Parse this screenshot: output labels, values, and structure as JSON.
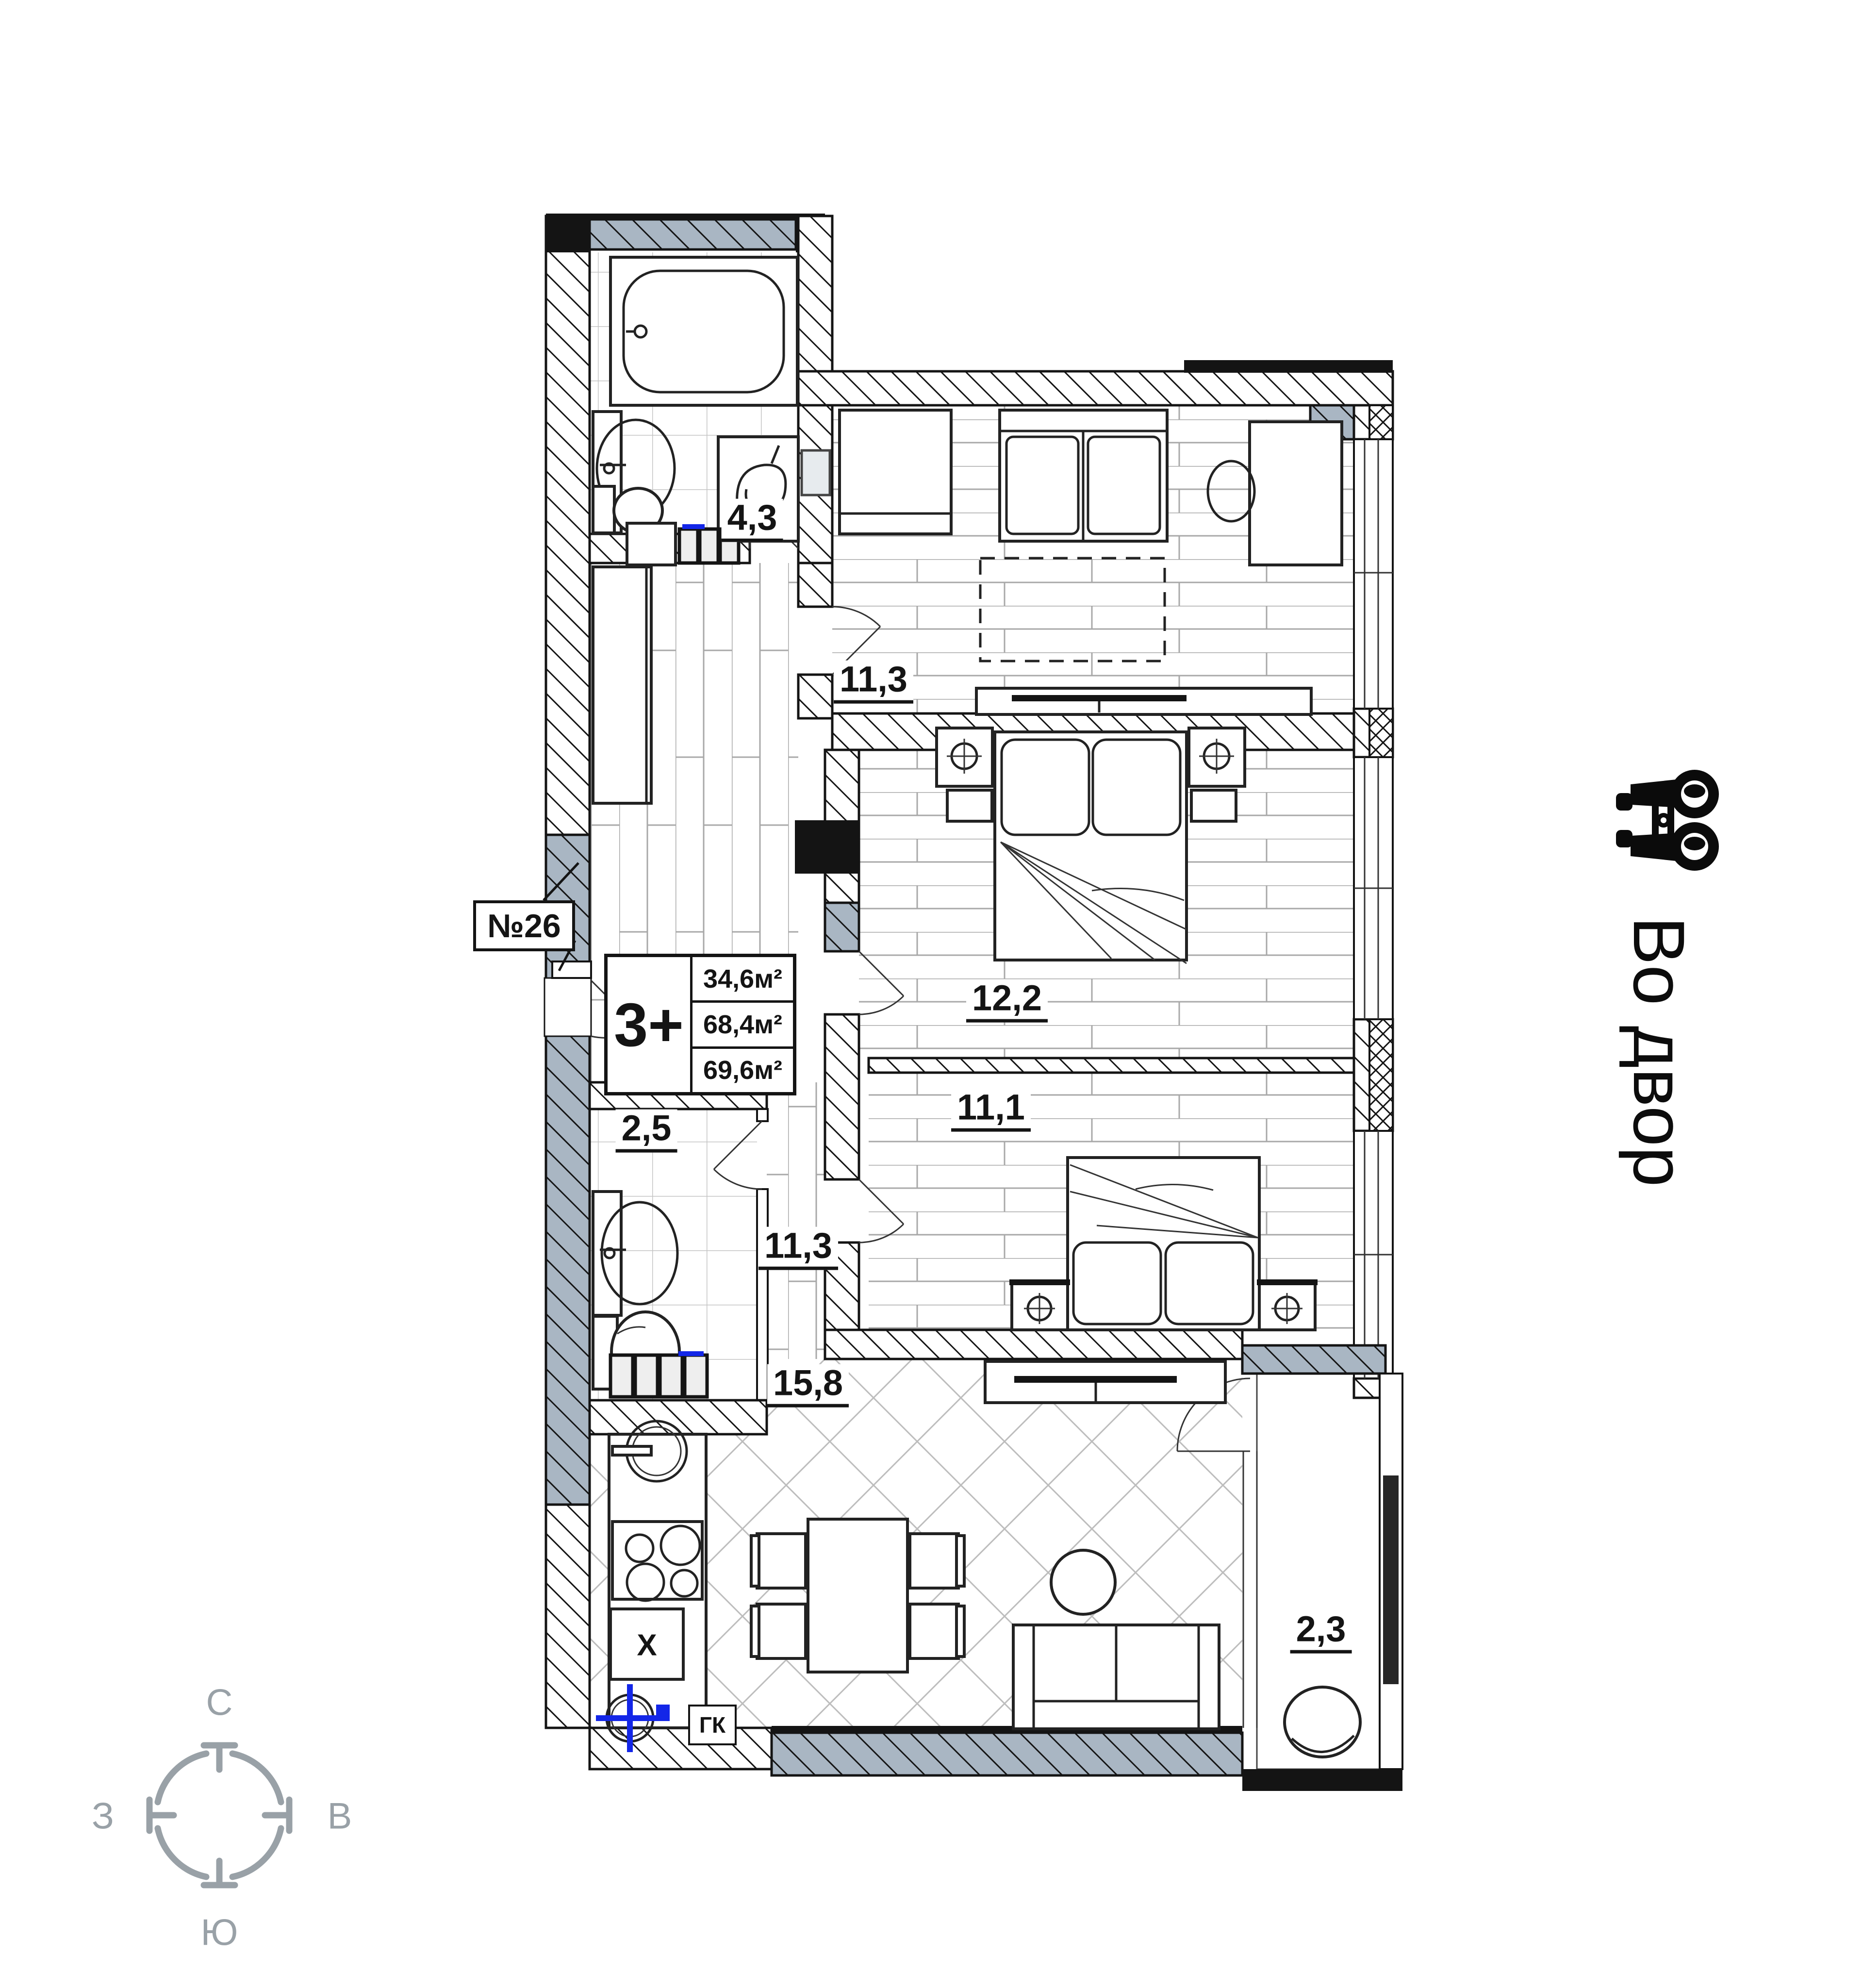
{
  "title": "Floor plan",
  "apartment": {
    "number": "№26",
    "type": "3+",
    "areas": [
      "34,6м²",
      "68,4м²",
      "69,6м²"
    ]
  },
  "rooms": [
    {
      "name": "bathroom-top",
      "area": "4,3"
    },
    {
      "name": "bedroom-top",
      "area": "11,3"
    },
    {
      "name": "bedroom-middle",
      "area": "12,2"
    },
    {
      "name": "bedroom-bottom",
      "area": "11,1"
    },
    {
      "name": "bathroom-small",
      "area": "2,5"
    },
    {
      "name": "hallway",
      "area": "11,3"
    },
    {
      "name": "kitchen-living",
      "area": "15,8"
    },
    {
      "name": "balcony",
      "area": "2,3"
    }
  ],
  "annotations": {
    "closet": "ГК",
    "appliance": "Х",
    "view_direction": "Во двор"
  },
  "compass": {
    "north": "С",
    "south": "Ю",
    "west": "З",
    "east": "В"
  },
  "colors": {
    "wall": "#141414",
    "window_fill": "#a9b6c3",
    "compass": "#99a1a7",
    "accent_blue": "#1326e8"
  }
}
